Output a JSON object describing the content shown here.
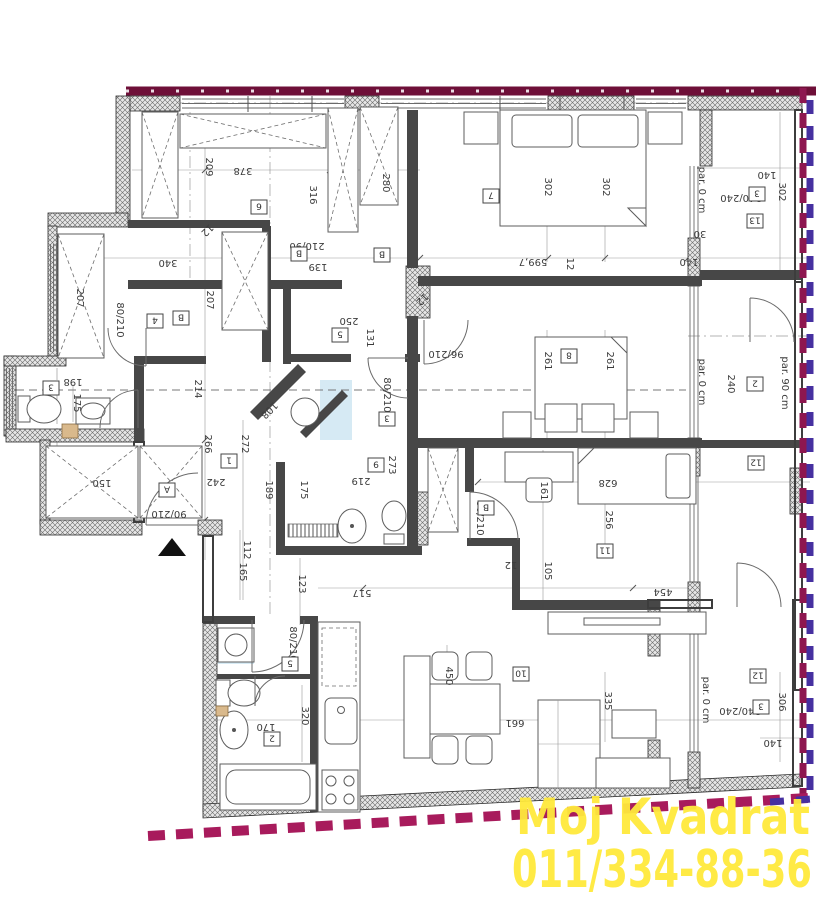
{
  "title": "apartment-floor-plan",
  "watermark": {
    "line1": "Moj Kvadrat",
    "line2": "011/334-88-36",
    "color": "#ffe93c"
  },
  "colors": {
    "wm": "#ffe93c",
    "btop": "#6e0f38",
    "bbot": "#a81b5c",
    "bmar": "#8e1750",
    "bpur": "#4630a0",
    "ink": "#3b3b3b",
    "wall": "#474747"
  },
  "plan": {
    "room_boxes": [
      {
        "n": "6",
        "x": 259,
        "y": 207
      },
      {
        "n": "7",
        "x": 491,
        "y": 196
      },
      {
        "n": "4",
        "x": 155,
        "y": 321
      },
      {
        "n": "B",
        "x": 181,
        "y": 318
      },
      {
        "n": "5",
        "x": 340,
        "y": 335
      },
      {
        "n": "3",
        "x": 51,
        "y": 388
      },
      {
        "n": "A",
        "x": 167,
        "y": 490
      },
      {
        "n": "1",
        "x": 229,
        "y": 461
      },
      {
        "n": "9",
        "x": 376,
        "y": 465
      },
      {
        "n": "3",
        "x": 387,
        "y": 419
      },
      {
        "n": "8",
        "x": 569,
        "y": 356
      },
      {
        "n": "2",
        "x": 755,
        "y": 384
      },
      {
        "n": "11",
        "x": 605,
        "y": 551
      },
      {
        "n": "12",
        "x": 756,
        "y": 463
      },
      {
        "n": "13",
        "x": 755,
        "y": 221
      },
      {
        "n": "3",
        "x": 757,
        "y": 194
      },
      {
        "n": "12",
        "x": 758,
        "y": 676
      },
      {
        "n": "3",
        "x": 761,
        "y": 707
      },
      {
        "n": "10",
        "x": 521,
        "y": 674
      },
      {
        "n": "2",
        "x": 272,
        "y": 739
      },
      {
        "n": "5",
        "x": 290,
        "y": 664
      },
      {
        "n": "B",
        "x": 299,
        "y": 254
      },
      {
        "n": "B",
        "x": 382,
        "y": 255
      },
      {
        "n": "B",
        "x": 486,
        "y": 508
      }
    ],
    "dim_labels": [
      {
        "t": "209",
        "x": 206,
        "y": 167,
        "r": 90
      },
      {
        "t": "378",
        "x": 243,
        "y": 168,
        "r": 180
      },
      {
        "t": "316",
        "x": 310,
        "y": 195,
        "r": 90
      },
      {
        "t": "280",
        "x": 383,
        "y": 183,
        "r": 90
      },
      {
        "t": "302",
        "x": 545,
        "y": 187,
        "r": 90
      },
      {
        "t": "302",
        "x": 603,
        "y": 187,
        "r": 90
      },
      {
        "t": "140",
        "x": 767,
        "y": 172,
        "r": 180
      },
      {
        "t": "302",
        "x": 779,
        "y": 192,
        "r": 90
      },
      {
        "t": "30",
        "x": 700,
        "y": 231,
        "r": 180
      },
      {
        "t": "140",
        "x": 689,
        "y": 259,
        "r": 180
      },
      {
        "t": "340",
        "x": 168,
        "y": 260,
        "r": 180
      },
      {
        "t": "207",
        "x": 77,
        "y": 298,
        "r": 90
      },
      {
        "t": "207",
        "x": 207,
        "y": 300,
        "r": 90
      },
      {
        "t": "250",
        "x": 349,
        "y": 318,
        "r": 180
      },
      {
        "t": "131",
        "x": 367,
        "y": 338,
        "r": 90
      },
      {
        "t": "139",
        "x": 318,
        "y": 264,
        "r": 180,
        "s": 9
      },
      {
        "t": "599,7",
        "x": 533,
        "y": 259,
        "r": 180
      },
      {
        "t": "12",
        "x": 567,
        "y": 264,
        "r": 90,
        "s": 8
      },
      {
        "t": "198",
        "x": 73,
        "y": 379,
        "r": 180
      },
      {
        "t": "175",
        "x": 74,
        "y": 403,
        "r": 90
      },
      {
        "t": "214",
        "x": 195,
        "y": 389,
        "r": 90
      },
      {
        "t": "266",
        "x": 205,
        "y": 444,
        "r": 90
      },
      {
        "t": "272",
        "x": 242,
        "y": 444,
        "r": 90
      },
      {
        "t": "242",
        "x": 216,
        "y": 479,
        "r": 180
      },
      {
        "t": "108",
        "x": 267,
        "y": 408,
        "r": 135
      },
      {
        "t": "189",
        "x": 266,
        "y": 490,
        "r": 90
      },
      {
        "t": "175",
        "x": 301,
        "y": 490,
        "r": 90
      },
      {
        "t": "219",
        "x": 361,
        "y": 478,
        "r": 180
      },
      {
        "t": "273",
        "x": 389,
        "y": 465,
        "r": 90
      },
      {
        "t": "150",
        "x": 102,
        "y": 480,
        "r": 180
      },
      {
        "t": "112",
        "x": 244,
        "y": 550,
        "r": 90
      },
      {
        "t": "165",
        "x": 240,
        "y": 572,
        "r": 90
      },
      {
        "t": "123",
        "x": 299,
        "y": 584,
        "r": 90
      },
      {
        "t": "517",
        "x": 362,
        "y": 590,
        "r": 180
      },
      {
        "t": "261",
        "x": 545,
        "y": 361,
        "r": 90
      },
      {
        "t": "261",
        "x": 607,
        "y": 361,
        "r": 90
      },
      {
        "t": "161",
        "x": 541,
        "y": 491,
        "r": 90
      },
      {
        "t": "628",
        "x": 608,
        "y": 480,
        "r": 180
      },
      {
        "t": "256",
        "x": 606,
        "y": 520,
        "r": 90
      },
      {
        "t": "105",
        "x": 545,
        "y": 571,
        "r": 90
      },
      {
        "t": "454",
        "x": 663,
        "y": 589,
        "r": 180
      },
      {
        "t": "12",
        "x": 511,
        "y": 562,
        "r": 180,
        "s": 9
      },
      {
        "t": "335",
        "x": 605,
        "y": 701,
        "r": 90
      },
      {
        "t": "661",
        "x": 515,
        "y": 720,
        "r": 180
      },
      {
        "t": "450",
        "x": 446,
        "y": 676,
        "r": 90
      },
      {
        "t": "320",
        "x": 302,
        "y": 716,
        "r": 90
      },
      {
        "t": "170",
        "x": 266,
        "y": 724,
        "r": 180
      },
      {
        "t": "306",
        "x": 779,
        "y": 702,
        "r": 90
      },
      {
        "t": "140",
        "x": 773,
        "y": 740,
        "r": 180
      },
      {
        "t": "90/210",
        "x": 169,
        "y": 511,
        "r": 180,
        "s": 7
      },
      {
        "t": "80/210",
        "x": 290,
        "y": 644,
        "r": 90,
        "s": 7
      },
      {
        "t": "80/210",
        "x": 384,
        "y": 395,
        "r": 90,
        "s": 7
      },
      {
        "t": "80/210",
        "x": 117,
        "y": 320,
        "r": 90,
        "s": 7
      },
      {
        "t": "96/210",
        "x": 446,
        "y": 351,
        "r": 180,
        "s": 7
      },
      {
        "t": "80/210",
        "x": 477,
        "y": 518,
        "r": 90,
        "s": 7
      },
      {
        "t": "210/90",
        "x": 307,
        "y": 243,
        "r": 180,
        "s": 7
      },
      {
        "t": "240/240",
        "x": 741,
        "y": 195,
        "r": 180,
        "s": 7
      },
      {
        "t": "240/240",
        "x": 740,
        "y": 708,
        "r": 180,
        "s": 7
      },
      {
        "t": "240",
        "x": 728,
        "y": 384,
        "r": 90,
        "s": 7
      },
      {
        "t": "par. 0 cm",
        "x": 699,
        "y": 190,
        "r": 90,
        "s": 7
      },
      {
        "t": "par. 0 cm",
        "x": 699,
        "y": 382,
        "r": 90,
        "s": 7
      },
      {
        "t": "par. 90 cm",
        "x": 782,
        "y": 383,
        "r": 90,
        "s": 7
      },
      {
        "t": "par. 0 cm",
        "x": 703,
        "y": 700,
        "r": 90,
        "s": 7
      },
      {
        "t": "12",
        "x": 205,
        "y": 228,
        "r": 135,
        "s": 9,
        "c": "#b0432e"
      },
      {
        "t": "12",
        "x": 420,
        "y": 297,
        "r": 135,
        "s": 9,
        "c": "#b0432e"
      }
    ]
  }
}
